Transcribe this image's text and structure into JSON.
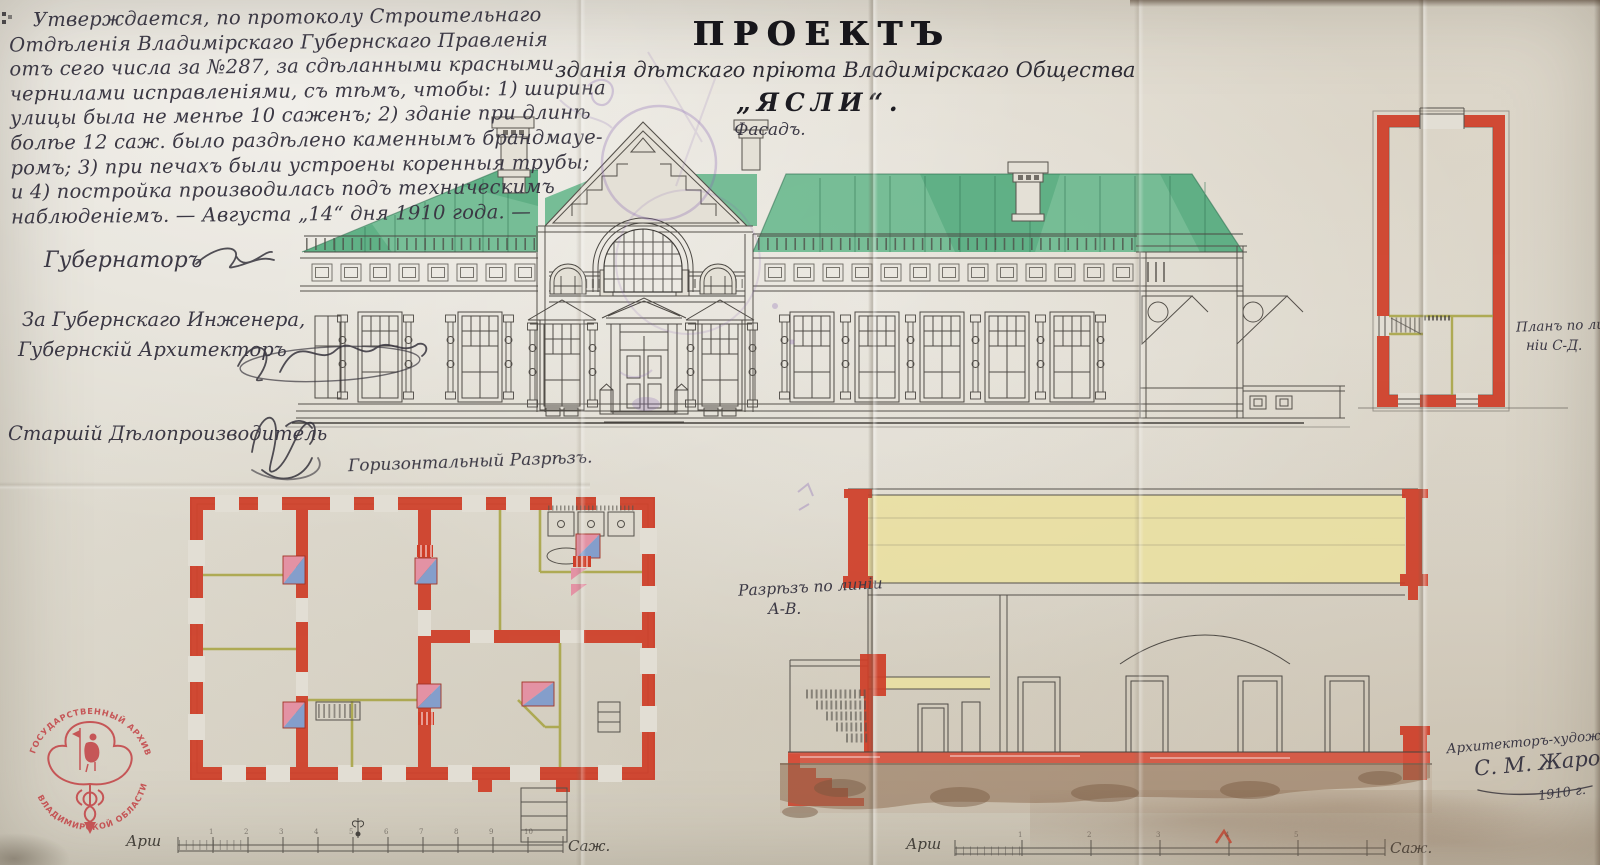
{
  "approval": {
    "lines": [
      "Утверждается, по протоколу Строительнаго",
      "Отдѣленія Владимірскаго Губернскаго Правленія",
      "отъ сего числа за №287, за сдѣланными красными",
      "чернилами исправленіями, съ тѣмъ, чтобы: 1) ширина",
      "улицы была не менѣе 10 саженъ; 2) зданіе при длинѣ",
      "болѣе 12 саж. было раздѣлено каменнымъ брандмауе-",
      "ромъ; 3) при печахъ были устроены коренныя трубы;",
      "и 4) постройка производилась подъ техническимъ",
      "наблюденіемъ. — Августа „14“ дня 1910 года. —"
    ]
  },
  "officials": {
    "governor_label": "Губернаторъ",
    "engineer_prefix": "За Губернскаго Инженера,",
    "architect_label": "Губернскій Архитекторъ",
    "clerk_label": "Старшій Дѣлопроизводитель"
  },
  "title": {
    "project": "ПРОЕКТЪ",
    "subtitle": "зданія дѣтскаго пріюта Владимірскаго Общества",
    "building_name": "„ЯСЛИ“.",
    "facade_label": "Фасадъ."
  },
  "drawing_labels": {
    "floor_plan": "Горизонтальный Разрѣзъ.",
    "section_line1": "Разрѣзъ по линіи",
    "section_line2": "А-В.",
    "side_plan_line1": "Планъ по ли-",
    "side_plan_line2": "ніи С-Д."
  },
  "architect_signature": {
    "title": "Архитекторъ-художникъ",
    "name": "С. М. Жаровъ",
    "year": "1910 г."
  },
  "stamp": {
    "text_top": "ГОСУДАРСТВЕННЫЙ АРХИВ",
    "text_bottom": "ВЛАДИМИРСКОЙ ОБЛАСТИ"
  },
  "scale_bars": [
    {
      "unit_left": "Арш",
      "unit_right": "Саж.",
      "numbers": [
        "1",
        "2",
        "3",
        "4",
        "5",
        "6",
        "7",
        "8",
        "9",
        "10"
      ]
    },
    {
      "unit_left": "Арш",
      "unit_right": "Саж.",
      "numbers": [
        "1",
        "2",
        "3",
        "4",
        "5"
      ]
    }
  ],
  "colors": {
    "paper": "#e0dcd1",
    "wall_red": "#cf3e28",
    "roof_green": "#63b489",
    "attic_yellow": "#e9e0a2",
    "ground_brown": "#8a684c",
    "stamp_red": "#c4393d",
    "ink": "#37343e",
    "pencil": "#59554f",
    "stamp_purple": "#8568b2",
    "stove_pink": "#e392a4",
    "stove_blue": "#849ecb",
    "partition_olive": "#a6a23f"
  }
}
